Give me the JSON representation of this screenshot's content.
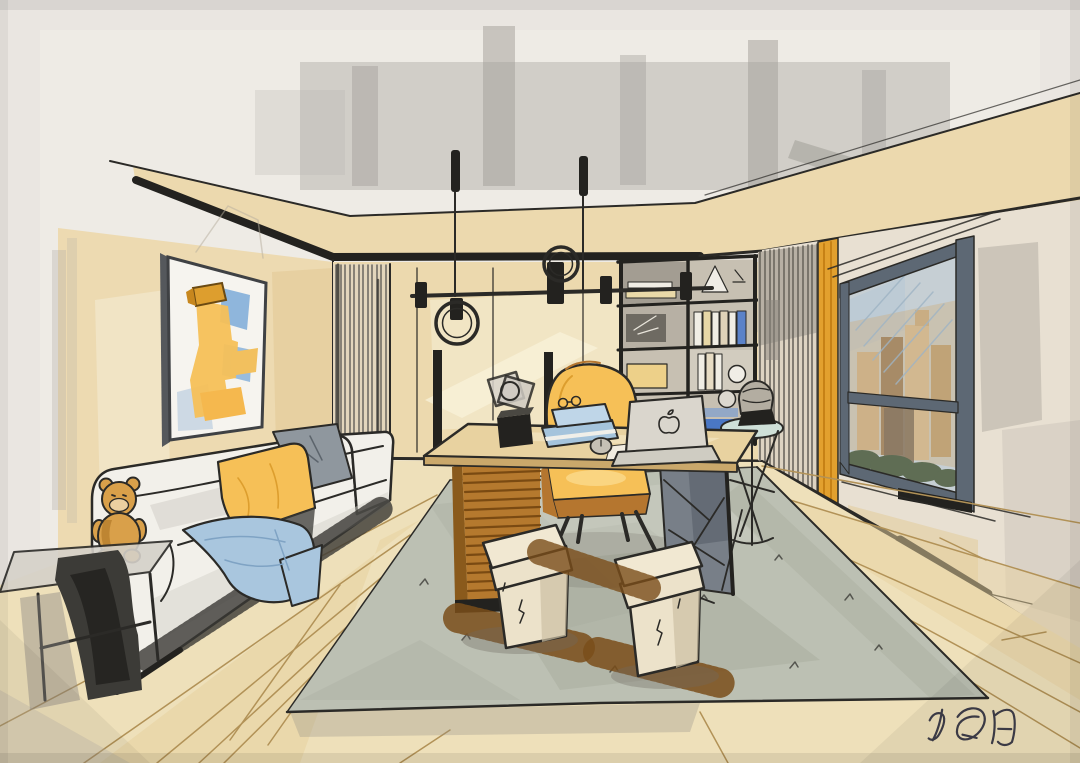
{
  "artwork": {
    "kind": "Hand-drawn interior design marker sketch",
    "scene": "Modern home office: sofa with pillows and teddy bear, writing desk with laptop and chair, bookshelf, pendant lights, rug, slatted partition, orange curtain and city-view window",
    "signature": {
      "text": "冯冠阳",
      "position": "bottom-right"
    }
  },
  "palette": {
    "paper": "#eae6e1",
    "ink": "#2b2a27",
    "black": "#23221f",
    "wallBeige": "#ecd9ae",
    "wallDeep": "#e2c993",
    "ceilGray": "#b3b1ab",
    "ceilGrayDark": "#a19e98",
    "floorBeige": "#eee0ba",
    "floorWarm": "#e7d29f",
    "plank": "#b29257",
    "rug": "#bcc0b3",
    "rugShade": "#a6aa9c",
    "rugLight": "#d0d3c8",
    "sofa": "#f2f0ea",
    "sofaShade": "#d4d1c9",
    "accentYellow": "#f6c057",
    "yellowDeep": "#dd9e2e",
    "pillowGray": "#8f979e",
    "throwBlue": "#a9c6de",
    "bookBlue": "#a5c4dc",
    "brightBlue": "#3f6fc8",
    "wood": "#b5792e",
    "woodDark": "#7a4a12",
    "chairShell": "#b5762f",
    "stool": "#ece2ca",
    "stoolShade": "#cdc1a4",
    "panelGray": "#787f88",
    "frameGray": "#5d6874",
    "glassSky": "#c6cfd4",
    "cityTan": "#cdb188",
    "cityBrown": "#a78b67",
    "greenery": "#5f6d54",
    "curtainOrange": "#e2a02e",
    "helmetGray": "#b3ada1",
    "canvas": "#f6f4ef",
    "paintBlue": "#8fb6dc",
    "slatLine": "#6b675f",
    "shadowSoft": "#6f6b60",
    "hatchBrown": "#7a4e1a",
    "teddy": "#d9a04a",
    "sigInk": "#3f3e49"
  }
}
